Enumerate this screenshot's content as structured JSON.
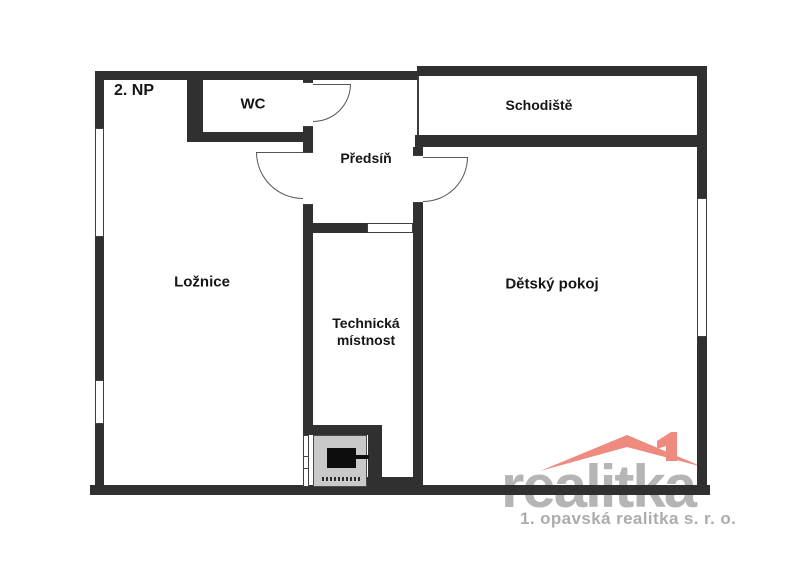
{
  "plan": {
    "floor_label": "2. NP",
    "rooms": {
      "wc": "WC",
      "predsin": "Předsíň",
      "schodiste": "Schodiště",
      "loznice": "Ložnice",
      "detsky_pokoj": "Dětský pokoj",
      "technicka_line1": "Technická",
      "technicka_line2": "místnost"
    }
  },
  "logo": {
    "brand": "realitka",
    "subtitle": "1. opavská realitka s. r. o.",
    "roof_color": "#ef8a7e",
    "brand_color": "#b5b5b5",
    "subtitle_color": "#acacac"
  },
  "colors": {
    "wall": "#303030",
    "boiler_fill": "#c9c9c9"
  }
}
